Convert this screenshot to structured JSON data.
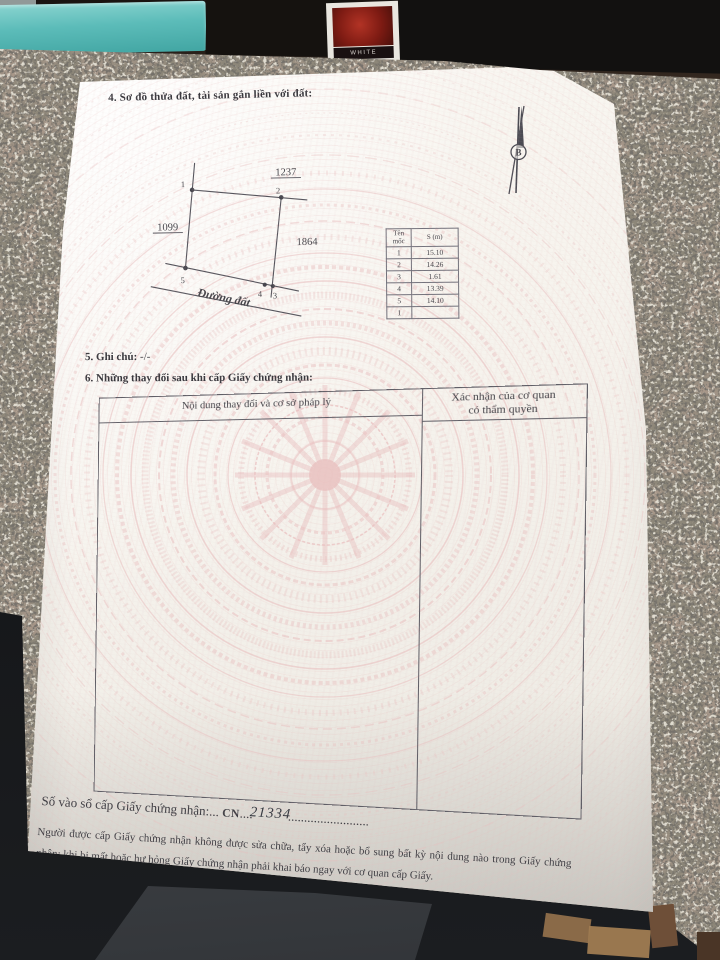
{
  "doc": {
    "section4_title": "4. Sơ đồ thửa đất, tài sản gắn liền với đất:",
    "north_label": "B",
    "diagram": {
      "plot_top": "1237",
      "plot_left": "1099",
      "plot_right": "1864",
      "road_label": "Đường đất",
      "vertices": [
        "1",
        "2",
        "3",
        "4",
        "5"
      ]
    },
    "edge_table": {
      "col1_header": "Tên mốc",
      "col2_header": "S (m)",
      "moc": [
        "1",
        "2",
        "3",
        "4",
        "5",
        "1"
      ],
      "s": [
        "15.10",
        "14.26",
        "1.61",
        "13.39",
        "14.10"
      ]
    },
    "section5_label": "5. Ghi chú:",
    "section5_value": "-/-",
    "section6_title": "6. Những thay đổi sau khi cấp Giấy chứng nhận:",
    "changes_table": {
      "col1_header": "Nội dung thay đổi và cơ sở pháp lý",
      "col2_header_line1": "Xác nhận của cơ quan",
      "col2_header_line2": "có thẩm quyền"
    },
    "book_entry": {
      "label": "Số vào sổ cấp Giấy chứng nhận:",
      "dots1": "...",
      "code": "CN",
      "dots2": "....",
      "number": "21334",
      "dots3": "........................."
    },
    "footer_text": "Người được cấp Giấy chứng nhận không được sửa chữa, tẩy xóa hoặc bổ sung bất kỳ nội dung nào trong Giấy chứng nhận; khi bị mất hoặc hư hỏng Giấy chứng nhận phải khai báo ngay với cơ quan cấp Giấy."
  },
  "bg": {
    "card_label": "WHITE"
  },
  "colors": {
    "guilloche_pink": "#e9bfbf",
    "teal_box": "#57b8b5",
    "granite_base": "#8d8779",
    "ink": "#3f3e44"
  }
}
